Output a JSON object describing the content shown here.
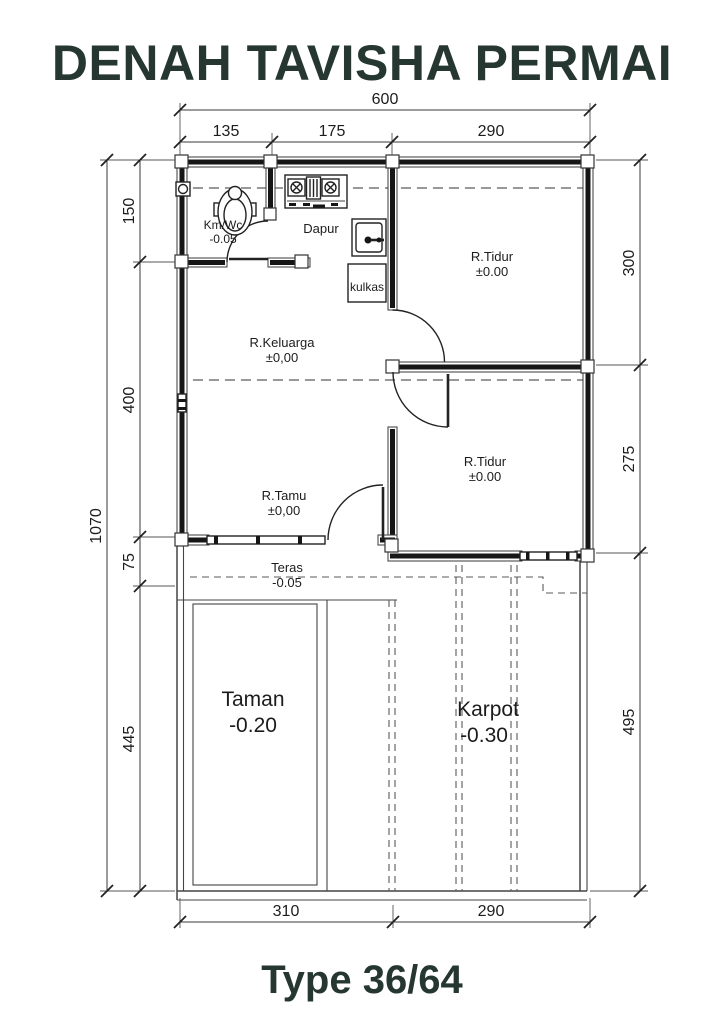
{
  "title": "DENAH TAVISHA PERMAI",
  "footer": {
    "type_label": "Type 36/64"
  },
  "colors": {
    "title_text": "#263731",
    "wall_fill": "#161616",
    "line": "#3a3a3a",
    "dashed_line": "#5a5a5a",
    "label_text": "#1c1c1c",
    "background": "#ffffff"
  },
  "dimensions": {
    "top": {
      "total": "600",
      "segments": [
        "135",
        "175",
        "290"
      ]
    },
    "left": {
      "total": "1070",
      "segments": [
        "150",
        "400",
        "75",
        "445"
      ]
    },
    "right": {
      "segments": [
        "300",
        "275",
        "495"
      ]
    },
    "bottom": {
      "segments": [
        "310",
        "290"
      ]
    }
  },
  "rooms": {
    "kmwc": {
      "name": "Km/Wc",
      "level": "-0.05"
    },
    "dapur": {
      "name": "Dapur"
    },
    "kulkas": {
      "name": "kulkas"
    },
    "tidur1": {
      "name": "R.Tidur",
      "level": "±0.00"
    },
    "keluarga": {
      "name": "R.Keluarga",
      "level": "±0,00"
    },
    "tamu": {
      "name": "R.Tamu",
      "level": "±0,00"
    },
    "tidur2": {
      "name": "R.Tidur",
      "level": "±0.00"
    },
    "teras": {
      "name": "Teras",
      "level": "-0.05"
    },
    "taman": {
      "name": "Taman",
      "level": "-0.20"
    },
    "karpot": {
      "name": "Karpot",
      "level": "-0.30"
    }
  },
  "fixtures": [
    "toilet-icon",
    "stove-icon",
    "sink-icon",
    "fridge-box"
  ]
}
